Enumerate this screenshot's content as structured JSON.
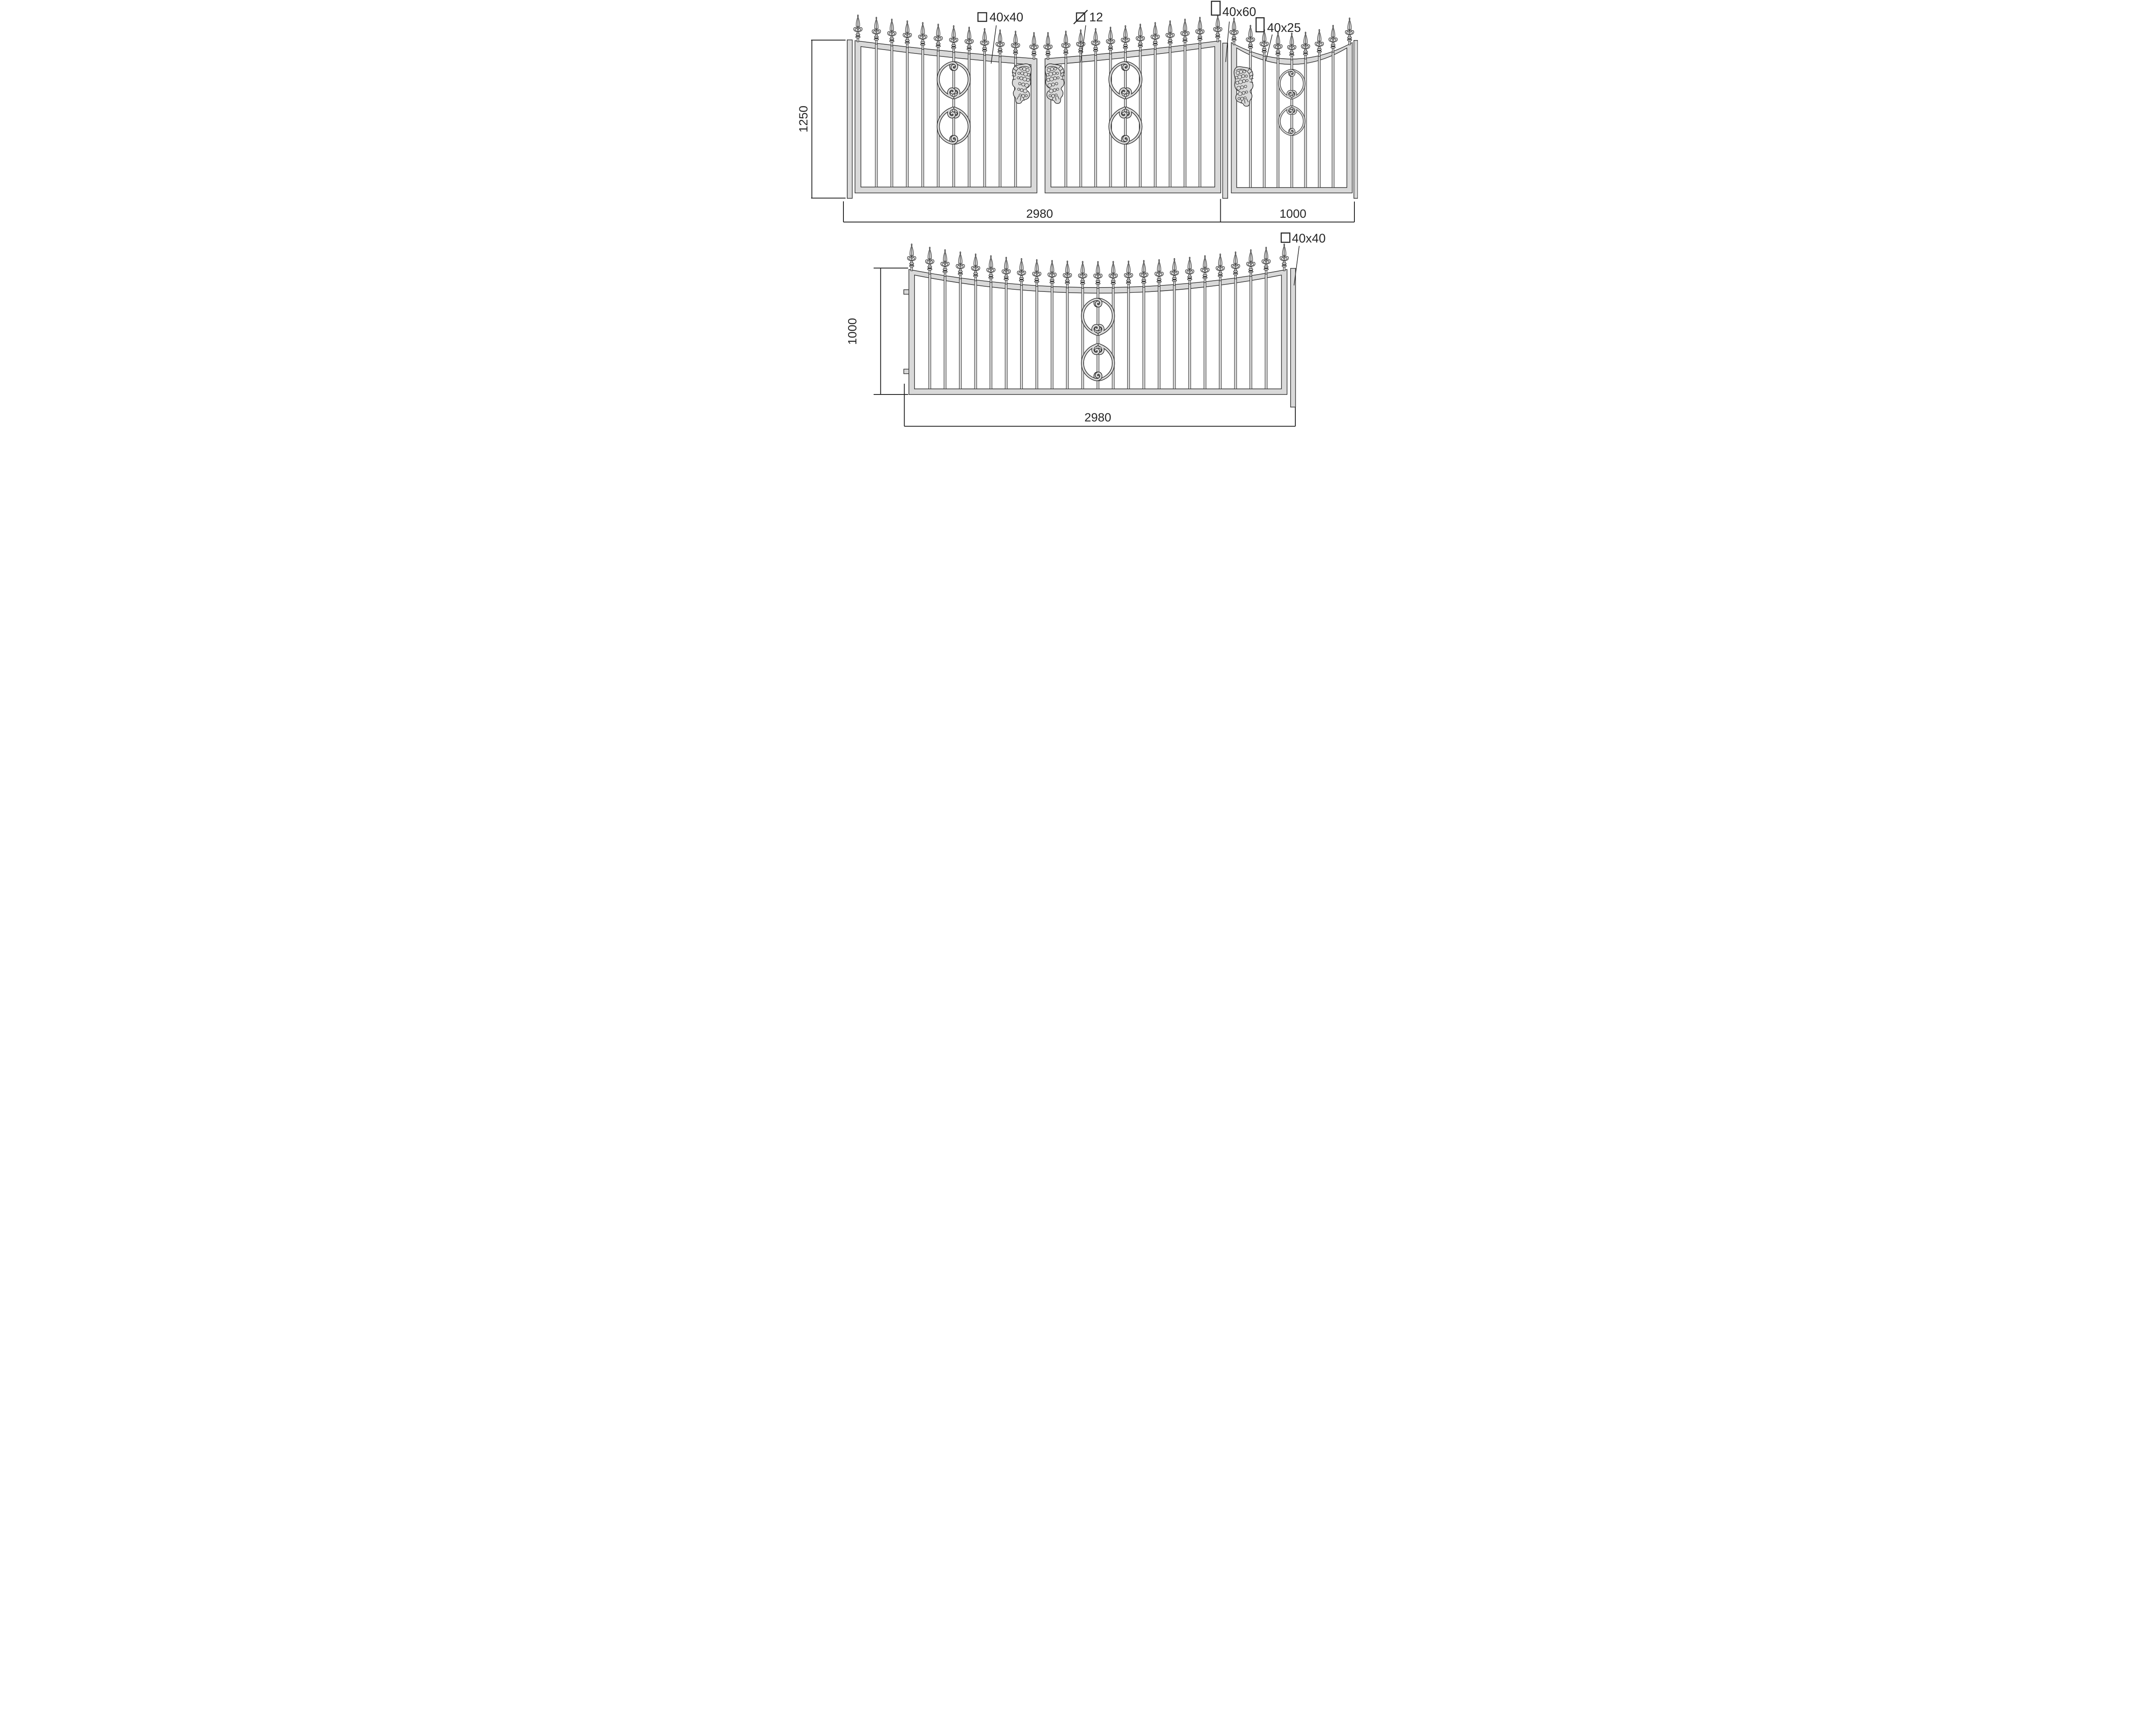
{
  "callouts": {
    "gate_frame": {
      "symbol": "square",
      "label": "40x40"
    },
    "baluster": {
      "symbol": "square-diagonal",
      "label": "12"
    },
    "main_post": {
      "symbol": "rect-40x60",
      "label": "40x60"
    },
    "wicket_frame": {
      "symbol": "rect-40x25",
      "label": "40x25"
    },
    "fence_post": {
      "symbol": "square",
      "label": "40x40"
    }
  },
  "dimensions": {
    "gate_assembly_height_mm": "1250",
    "gate_width_mm": "2980",
    "wicket_width_mm": "1000",
    "fence_height_mm": "1000",
    "fence_width_mm": "2980"
  },
  "structure": {
    "gate_leaves": {
      "count": 2,
      "bars_per_leaf": 10
    },
    "wicket": {
      "bars": 7
    },
    "fence_panel": {
      "bars": 23,
      "hinge_tabs": 2
    },
    "colors": {
      "metal_fill": "#d9d9d9",
      "outline": "#2f2f2f",
      "annotation": "#262626"
    }
  }
}
